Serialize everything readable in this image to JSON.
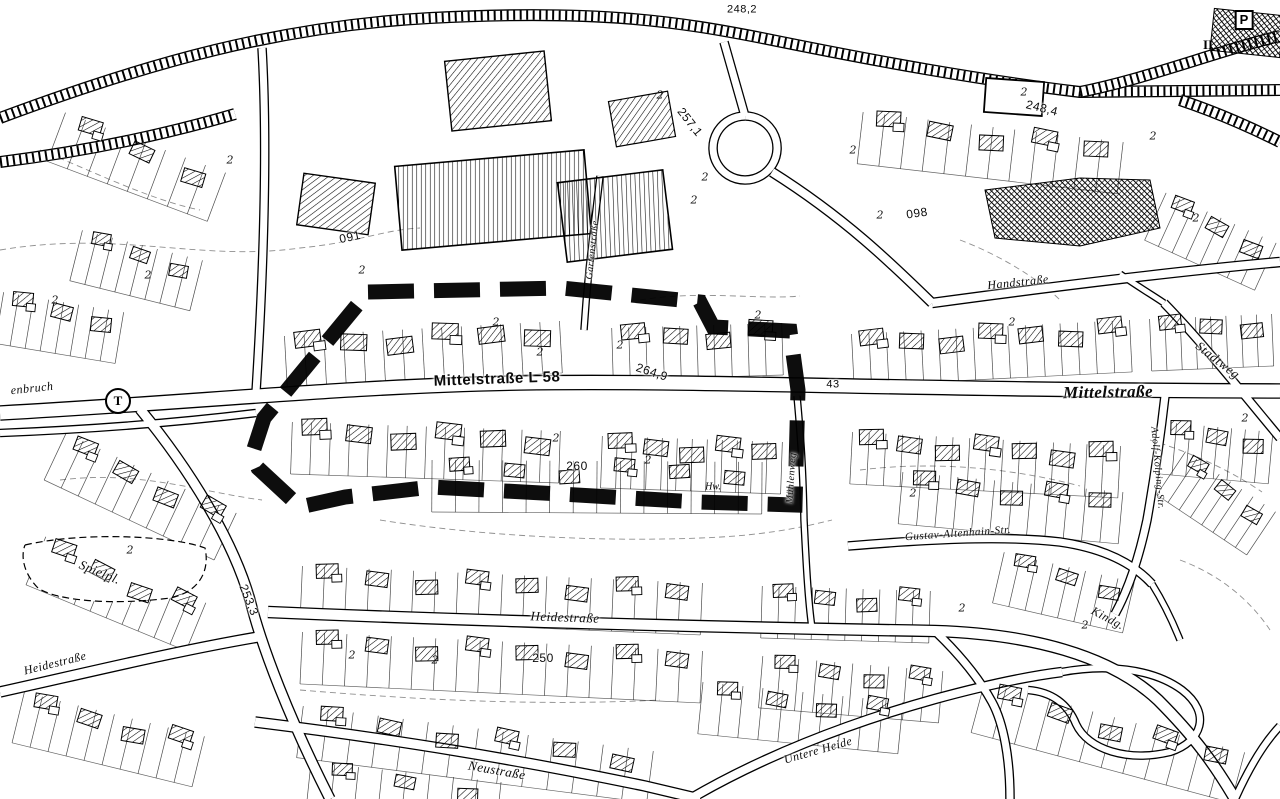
{
  "map": {
    "paper_color": "#ffffff",
    "ink_color": "#0a0a0a",
    "plan_boundary": {
      "description": "heavy black dashed outline of plan area along Mittelstrasse",
      "color": "#000000",
      "style": "dashed",
      "points": [
        [
          368,
          292
        ],
        [
          562,
          288
        ],
        [
          700,
          302
        ],
        [
          713,
          327
        ],
        [
          790,
          331
        ],
        [
          798,
          390
        ],
        [
          795,
          505
        ],
        [
          698,
          502
        ],
        [
          560,
          494
        ],
        [
          432,
          487
        ],
        [
          345,
          497
        ],
        [
          300,
          507
        ],
        [
          258,
          468
        ],
        [
          252,
          455
        ],
        [
          264,
          418
        ],
        [
          368,
          292
        ]
      ]
    },
    "street_labels": [
      {
        "text": "Mittelstraße L 58",
        "x": 497,
        "y": 379,
        "rot": -2,
        "size": 15,
        "font": "sans",
        "bold": true,
        "italic": false
      },
      {
        "text": "Mittelstraße",
        "x": 1108,
        "y": 392,
        "rot": -1,
        "size": 17,
        "font": "serif",
        "bold": true,
        "italic": true
      },
      {
        "text": "Heidestraße",
        "x": 565,
        "y": 617,
        "rot": 2,
        "size": 13,
        "font": "serif",
        "bold": false,
        "italic": true
      },
      {
        "text": "Heidestraße",
        "x": 55,
        "y": 663,
        "rot": -14,
        "size": 12,
        "font": "serif",
        "bold": false,
        "italic": true
      },
      {
        "text": "Neustraße",
        "x": 497,
        "y": 770,
        "rot": 10,
        "size": 13,
        "font": "serif",
        "bold": false,
        "italic": true
      },
      {
        "text": "Untere Heide",
        "x": 818,
        "y": 750,
        "rot": -16,
        "size": 12,
        "font": "serif",
        "bold": false,
        "italic": true
      },
      {
        "text": "Handstraße",
        "x": 1018,
        "y": 282,
        "rot": -6,
        "size": 12,
        "font": "serif",
        "bold": false,
        "italic": true
      },
      {
        "text": "Stadtweg",
        "x": 1218,
        "y": 360,
        "rot": 38,
        "size": 13,
        "font": "serif",
        "bold": false,
        "italic": true
      },
      {
        "text": "Gustav-Altenhain-Str.",
        "x": 958,
        "y": 534,
        "rot": -4,
        "size": 11,
        "font": "serif",
        "bold": false,
        "italic": true
      },
      {
        "text": "Spielpl.",
        "x": 100,
        "y": 572,
        "rot": 22,
        "size": 13,
        "font": "serif",
        "bold": false,
        "italic": true
      },
      {
        "text": "enbruch",
        "x": 32,
        "y": 388,
        "rot": -6,
        "size": 12,
        "font": "serif",
        "bold": false,
        "italic": true
      },
      {
        "text": "Kindg.",
        "x": 1108,
        "y": 618,
        "rot": 28,
        "size": 12,
        "font": "serif",
        "bold": false,
        "italic": true
      },
      {
        "text": "Gartenstraße",
        "x": 593,
        "y": 250,
        "rot": -84,
        "size": 10,
        "font": "serif",
        "bold": false,
        "italic": true
      },
      {
        "text": "Mühlenweg",
        "x": 792,
        "y": 478,
        "rot": -86,
        "size": 10,
        "font": "serif",
        "bold": false,
        "italic": true
      },
      {
        "text": "Adolf-Kolping-Str.",
        "x": 1157,
        "y": 468,
        "rot": 85,
        "size": 10,
        "font": "serif",
        "bold": false,
        "italic": true
      }
    ],
    "elevation_labels": [
      {
        "text": "248,2",
        "x": 742,
        "y": 10,
        "rot": 0,
        "size": 11
      },
      {
        "text": "257,1",
        "x": 690,
        "y": 122,
        "rot": 52,
        "size": 12
      },
      {
        "text": "248,4",
        "x": 1042,
        "y": 108,
        "rot": 14,
        "size": 12
      },
      {
        "text": "264,9",
        "x": 652,
        "y": 372,
        "rot": 18,
        "size": 12
      },
      {
        "text": "260",
        "x": 577,
        "y": 466,
        "rot": 0,
        "size": 12
      },
      {
        "text": "253,3",
        "x": 249,
        "y": 600,
        "rot": 68,
        "size": 12
      },
      {
        "text": "250",
        "x": 543,
        "y": 658,
        "rot": 0,
        "size": 12
      },
      {
        "text": "43",
        "x": 833,
        "y": 385,
        "rot": 0,
        "size": 11
      },
      {
        "text": "091",
        "x": 350,
        "y": 237,
        "rot": -12,
        "size": 12
      },
      {
        "text": "098",
        "x": 917,
        "y": 213,
        "rot": -8,
        "size": 12
      }
    ],
    "symbols": [
      {
        "text": "T",
        "x": 118,
        "y": 401,
        "shape": "circle",
        "name": "t-symbol"
      },
      {
        "text": "P",
        "x": 1244,
        "y": 20,
        "shape": "box",
        "name": "parking-symbol"
      },
      {
        "text": "II",
        "x": 1208,
        "y": 45,
        "shape": "plain",
        "size": 13,
        "bold": true,
        "name": "storey-ii-symbol"
      },
      {
        "text": "Hw.",
        "x": 713,
        "y": 487,
        "shape": "plain",
        "size": 10,
        "bold": false,
        "name": "hw-symbol"
      }
    ],
    "storey_marks": {
      "glyph": "2",
      "positions": [
        [
          148,
          275
        ],
        [
          55,
          300
        ],
        [
          362,
          270
        ],
        [
          496,
          322
        ],
        [
          540,
          352
        ],
        [
          620,
          345
        ],
        [
          694,
          200
        ],
        [
          660,
          95
        ],
        [
          758,
          315
        ],
        [
          853,
          150
        ],
        [
          880,
          215
        ],
        [
          1024,
          92
        ],
        [
          1012,
          322
        ],
        [
          705,
          177
        ],
        [
          962,
          608
        ],
        [
          1085,
          625
        ],
        [
          435,
          660
        ],
        [
          352,
          655
        ],
        [
          556,
          438
        ],
        [
          648,
          460
        ],
        [
          230,
          160
        ],
        [
          130,
          550
        ],
        [
          1196,
          218
        ],
        [
          1245,
          418
        ],
        [
          913,
          493
        ],
        [
          1153,
          136
        ]
      ]
    }
  }
}
